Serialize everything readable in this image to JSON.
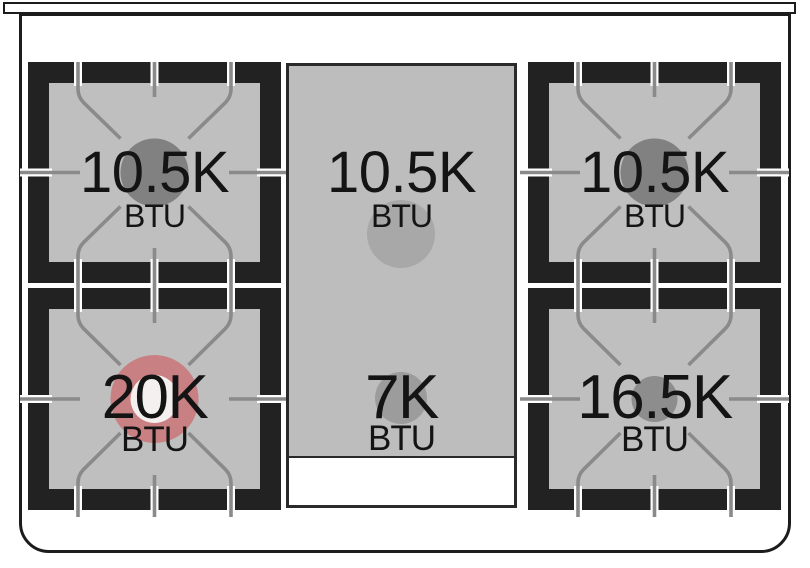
{
  "cooktop": {
    "burners": [
      {
        "position": "rear-left",
        "btu": "10.5K",
        "unit": "BTU",
        "cap_color": "#818181",
        "style": "grate"
      },
      {
        "position": "rear-center",
        "btu": "10.5K",
        "unit": "BTU",
        "cap_color": "#a8a8a8",
        "style": "griddle"
      },
      {
        "position": "rear-right",
        "btu": "10.5K",
        "unit": "BTU",
        "cap_color": "#818181",
        "style": "grate"
      },
      {
        "position": "front-left",
        "btu": "20K",
        "unit": "BTU",
        "cap_color": "#c88082",
        "cap_inner_color": "#f4f0f0",
        "style": "grate-dual-ring"
      },
      {
        "position": "front-center",
        "btu": "7K",
        "unit": "BTU",
        "cap_color": "#9c9c9c",
        "style": "griddle"
      },
      {
        "position": "front-right",
        "btu": "16.5K",
        "unit": "BTU",
        "cap_color": "#8d8d8d",
        "style": "grate"
      }
    ],
    "colors": {
      "frame_outline": "#1c1c1c",
      "grate_black": "#222222",
      "burner_surface": "#bfbfbf",
      "griddle_surface": "#bdbdbd",
      "grate_line": "#8a8a8a",
      "tick_highlight": "#ffffff",
      "label_text": "#141414",
      "background": "#ffffff"
    }
  }
}
